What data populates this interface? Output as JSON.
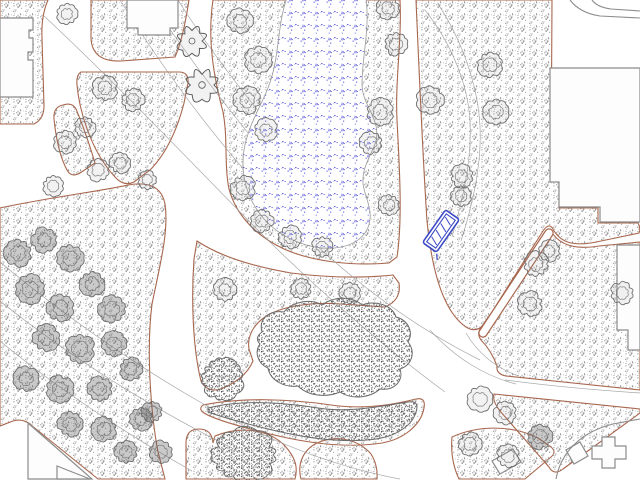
{
  "meta": {
    "kind": "landscape-site-plan",
    "width": 640,
    "height": 480
  },
  "colors": {
    "background": "#ffffff",
    "bed_edge": "#a8674e",
    "tree_stroke": "#6f6f6f",
    "tree_fill_normal": "rgba(130,130,130,0.10)",
    "tree_fill_dark": "rgba(80,80,80,0.30)",
    "flower_stroke": "#5c5c5c",
    "contour": "#9a9a9a",
    "building_fill": "#fdfdfd",
    "building_stroke": "#8c8c8c",
    "pond_stroke": "#9a9a9a",
    "pond_dot_palette": [
      "#3434cf",
      "#5151d8",
      "#8080e4",
      "#3434cf"
    ],
    "stipple_palette": [
      "#8e8e8e",
      "#a6a6a6",
      "#bcbcbc",
      "#cfcfcf"
    ],
    "stipple_dark_palette": [
      "#4f4f4f",
      "#636363",
      "#7a7a7a",
      "#909090"
    ],
    "mass_stroke": "#6a6a6a",
    "bench_blue": "#3a49c5"
  },
  "map": {
    "beds": [
      {
        "name": "bed-top-left-corner",
        "d": "M0,0 H48 Q41,16 42,38 L44,106 Q44,119 34,124 H0 Z"
      },
      {
        "name": "bed-top-strip",
        "d": "M91,0 H189 C185,26 181,44 175,57 L121,61 Q92,62 91,38 Z"
      },
      {
        "name": "bed-triangle",
        "d": "M81,72 Q76,75 77,85 C79,107 89,149 115,177 Q124,187 134,182 L150,170 C167,153 178,127 184,103 L188,83 Q189,72 179,72 Z"
      },
      {
        "name": "bed-small-left",
        "d": "M63,105 Q53,107 54,119 C56,139 60,157 67,170 Q71,178 80,173 L95,163 C89,143 82,123 76,109 Q72,102 63,105 Z"
      },
      {
        "name": "bed-pond-surround",
        "d": "M213,0 C207,40 214,78 223,112 C228,138 224,164 229,189 C236,215 256,236 284,249 C313,262 353,266 389,263 L397,257 C403,218 399,160 397,120 C395,80 402,40 400,0 Z"
      },
      {
        "name": "bed-left-large",
        "d": "M0,208 C46,198 101,191 128,185 C150,181 162,188 165,204 C169,231 160,265 152,304 C146,351 151,415 158,452 L165,479 L98,479 L31,425 Q23,418 13,421 L0,426 Z"
      },
      {
        "name": "bed-center",
        "d": "M197,241 C221,257 256,267 291,273 C331,278 366,278 393,275 L399,283 C401,295 395,303 385,307 L341,304 C311,302 281,306 265,317 C253,325 247,337 249,349 L253,361 C247,375 235,383 221,389 Q207,393 201,381 C193,349 191,301 194,259 Z"
      },
      {
        "name": "bed-snake",
        "d": "M203,405 C241,397 291,399 331,405 C366,410 396,404 416,399 Q426,397 424,408 C421,425 404,439 382,443 C344,449 300,442 262,432 C234,425 212,418 204,413 Q198,409 203,405 Z"
      },
      {
        "name": "bed-bottom-center",
        "d": "M186,479 L186,443 Q186,429 199,429 Q212,429 213,443 L215,436 C242,425 270,430 285,446 C296,458 298,468 295,479 Z"
      },
      {
        "name": "bed-bottom-mid",
        "d": "M301,479 C297,464 303,450 317,443 C337,434 359,440 371,454 Q378,465 377,479 Z"
      },
      {
        "name": "bed-bottom-right-low",
        "d": "M452,437 C478,425 512,425 538,438 L551,447 Q557,452 551,457 L525,479 L459,479 Q450,460 452,437 Z"
      },
      {
        "name": "bed-bottom-right-diagonal",
        "d": "M494,394 L640,409 L640,413 L563,469 Q554,476 549,467 L500,411 Q492,401 494,394 Z"
      },
      {
        "name": "bed-right-mid",
        "d": "M551,231 C559,245 575,250 599,246 L640,242 L640,390 L506,376 Q496,374 497,366 C493,355 487,346 481,340 Q476,333 482,326 Z"
      },
      {
        "name": "bed-right-main",
        "d": "M416,0 H552 L551,180 L559,182 L559,208 L598,208 L598,223 L638,223 Q641,228 639,233 L601,241 C576,247 561,244 553,229 Q549,222 543,231 L485,323 Q477,334 466,327 C444,312 432,272 427,221 C423,161 419,70 416,0 Z"
      }
    ],
    "narrow_paths": [
      {
        "name": "path-dead-end-diagonal",
        "d": "M549,233 L483,333",
        "width": 7
      }
    ],
    "pond": {
      "d": "M287,-2 C277,24 280,58 268,88 C260,108 248,126 244,150 C240,176 248,202 266,221 C284,240 312,250 334,248 C358,246 372,232 370,212 C368,196 360,188 364,171 C369,152 380,144 376,126 C372,110 362,100 362,84 C362,56 370,30 366,-2 Z"
    },
    "contours": [
      {
        "d": "M44,16 C100,68 170,140 240,212 C310,284 380,344 445,392"
      },
      {
        "d": "M120,0 C170,80 230,160 300,230 C360,288 420,330 480,360"
      },
      {
        "d": "M150,0 C200,75 255,145 315,210"
      },
      {
        "d": "M178,0 C222,70 280,140 340,205"
      },
      {
        "d": "M425,10 C450,42 468,82 470,122 C472,162 462,202 452,237"
      },
      {
        "d": "M438,4 C462,40 478,86 480,126 C482,166 472,206 461,241"
      },
      {
        "d": "M0,262 C60,312 130,362 200,402 C262,438 330,466 400,479"
      },
      {
        "d": "M0,301 C70,357 150,407 230,447"
      },
      {
        "d": "M0,341 C58,389 128,435 192,471"
      },
      {
        "d": "M430,330 C455,358 485,376 516,384"
      },
      {
        "d": "M466,333 C477,352 495,368 519,376"
      },
      {
        "d": "M505,380 C550,386 595,390 640,393"
      }
    ],
    "shrub_masses": [
      {
        "name": "shrub-mass-large",
        "type": "blob",
        "d": "M262,332 C258,318 270,310 284,312 C292,302 310,298 322,305 C334,296 352,296 362,305 C376,300 392,305 396,317 C408,320 414,332 408,342 C416,352 412,365 400,369 C404,381 394,391 380,389 C370,398 352,400 340,392 C326,398 308,396 298,386 C284,388 270,380 268,368 C258,364 254,352 260,344 Q254,338 262,332 Z"
      },
      {
        "name": "shrub-mass-snake",
        "type": "blob",
        "d": "M208,408 C240,400 280,402 318,408 C350,413 382,406 408,402 Q420,400 416,412 C412,426 396,436 376,439 C340,444 300,437 264,428 C236,421 216,415 208,412 Z"
      },
      {
        "name": "shrub-round-bush-1",
        "type": "round",
        "x": 244,
        "y": 455,
        "r": 33,
        "sy": 0.8
      },
      {
        "name": "shrub-round-bush-2",
        "type": "round",
        "x": 222,
        "y": 379,
        "r": 21,
        "sy": 1
      }
    ],
    "buildings": [
      {
        "name": "building-top-left",
        "d": "M0,18 H33 V30 H29 V38 H33 V52 H28 V60 H33 V97 H0 Z"
      },
      {
        "name": "building-top-small",
        "d": "M127,0 H178 V28 H170 V35 H138 V28 H127 Z"
      },
      {
        "name": "building-right-large",
        "d": "M550,68 H640 V222 H600 V207 H559 V182 H550 Z"
      },
      {
        "name": "building-right-mid",
        "d": "M617,245 H640 V350 H628 V330 H617 Z"
      },
      {
        "name": "building-bottom-right-cross",
        "d": "M592,446 h10 v-9 h13 v9 h11 v13 h-11 v9 h-13 v-9 h-10 Z"
      },
      {
        "name": "building-bottom-right-small",
        "d": "M566,450 l14,-8 8,14 -14,8 Z"
      },
      {
        "name": "building-bottom-center-small",
        "d": "M492,461 L513,449 L521,462 L500,474 Z"
      },
      {
        "name": "building-ramp-triangle-1",
        "d": "M28,423 L92,479 L28,479 Z"
      },
      {
        "name": "building-ramp-triangle-2",
        "d": "M57,466 L90,479 L57,479 Z"
      }
    ],
    "building_lines": [
      {
        "name": "building-arc-bottom-right",
        "d": "M556,479 C561,452 581,432 613,424 L640,419"
      },
      {
        "name": "building-curve-top-right-1",
        "d": "M570,0 Q580,13 600,16 L640,18"
      },
      {
        "name": "building-curve-top-right-2",
        "d": "M592,0 Q597,7 611,9 L640,11"
      }
    ],
    "trees": [
      {
        "x": 67,
        "y": 14,
        "r": 10,
        "style": "normal"
      },
      {
        "x": 105,
        "y": 88,
        "r": 12,
        "style": "normal"
      },
      {
        "x": 133,
        "y": 100,
        "r": 11,
        "style": "normal"
      },
      {
        "x": 85,
        "y": 127,
        "r": 10,
        "style": "normal"
      },
      {
        "x": 65,
        "y": 142,
        "r": 11,
        "style": "normal"
      },
      {
        "x": 98,
        "y": 170,
        "r": 11,
        "style": "normal"
      },
      {
        "x": 53,
        "y": 186,
        "r": 10,
        "style": "normal"
      },
      {
        "x": 120,
        "y": 163,
        "r": 10,
        "style": "normal"
      },
      {
        "x": 147,
        "y": 180,
        "r": 9,
        "style": "normal"
      },
      {
        "x": 192,
        "y": 41,
        "r": 12,
        "style": "flower"
      },
      {
        "x": 202,
        "y": 85,
        "r": 13,
        "style": "flower"
      },
      {
        "x": 240,
        "y": 21,
        "r": 12,
        "style": "normal"
      },
      {
        "x": 258,
        "y": 60,
        "r": 13,
        "style": "normal"
      },
      {
        "x": 247,
        "y": 100,
        "r": 13,
        "style": "normal"
      },
      {
        "x": 266,
        "y": 130,
        "r": 11,
        "style": "normal"
      },
      {
        "x": 243,
        "y": 188,
        "r": 12,
        "style": "normal"
      },
      {
        "x": 262,
        "y": 221,
        "r": 11,
        "style": "normal"
      },
      {
        "x": 290,
        "y": 237,
        "r": 11,
        "style": "normal"
      },
      {
        "x": 322,
        "y": 247,
        "r": 10,
        "style": "normal"
      },
      {
        "x": 388,
        "y": 8,
        "r": 11,
        "style": "normal"
      },
      {
        "x": 396,
        "y": 44,
        "r": 11,
        "style": "normal"
      },
      {
        "x": 380,
        "y": 112,
        "r": 13,
        "style": "normal"
      },
      {
        "x": 371,
        "y": 143,
        "r": 11,
        "style": "normal"
      },
      {
        "x": 389,
        "y": 205,
        "r": 10,
        "style": "normal"
      },
      {
        "x": 430,
        "y": 100,
        "r": 13,
        "style": "normal"
      },
      {
        "x": 490,
        "y": 65,
        "r": 12,
        "style": "normal"
      },
      {
        "x": 496,
        "y": 112,
        "r": 12,
        "style": "normal"
      },
      {
        "x": 462,
        "y": 176,
        "r": 11,
        "style": "normal"
      },
      {
        "x": 461,
        "y": 196,
        "r": 10,
        "style": "normal"
      },
      {
        "x": 536,
        "y": 264,
        "r": 12,
        "style": "normal"
      },
      {
        "x": 549,
        "y": 251,
        "r": 10,
        "style": "normal"
      },
      {
        "x": 530,
        "y": 304,
        "r": 12,
        "style": "normal"
      },
      {
        "x": 622,
        "y": 293,
        "r": 11,
        "style": "normal"
      },
      {
        "x": 480,
        "y": 399,
        "r": 12,
        "style": "normal"
      },
      {
        "x": 505,
        "y": 413,
        "r": 11,
        "style": "normal"
      },
      {
        "x": 540,
        "y": 437,
        "r": 12,
        "style": "dark"
      },
      {
        "x": 470,
        "y": 444,
        "r": 11,
        "style": "normal"
      },
      {
        "x": 508,
        "y": 456,
        "r": 11,
        "style": "normal"
      },
      {
        "x": 225,
        "y": 290,
        "r": 11,
        "style": "normal"
      },
      {
        "x": 301,
        "y": 289,
        "r": 10,
        "style": "normal"
      },
      {
        "x": 350,
        "y": 293,
        "r": 10,
        "style": "normal"
      },
      {
        "x": 18,
        "y": 253,
        "r": 13,
        "style": "dark"
      },
      {
        "x": 44,
        "y": 240,
        "r": 12,
        "style": "dark"
      },
      {
        "x": 70,
        "y": 258,
        "r": 13,
        "style": "dark"
      },
      {
        "x": 30,
        "y": 289,
        "r": 14,
        "style": "dark"
      },
      {
        "x": 60,
        "y": 308,
        "r": 13,
        "style": "dark"
      },
      {
        "x": 92,
        "y": 284,
        "r": 12,
        "style": "dark"
      },
      {
        "x": 112,
        "y": 309,
        "r": 13,
        "style": "dark"
      },
      {
        "x": 46,
        "y": 338,
        "r": 13,
        "style": "dark"
      },
      {
        "x": 80,
        "y": 349,
        "r": 14,
        "style": "dark"
      },
      {
        "x": 114,
        "y": 344,
        "r": 12,
        "style": "dark"
      },
      {
        "x": 26,
        "y": 379,
        "r": 12,
        "style": "dark"
      },
      {
        "x": 60,
        "y": 389,
        "r": 13,
        "style": "dark"
      },
      {
        "x": 100,
        "y": 389,
        "r": 12,
        "style": "dark"
      },
      {
        "x": 131,
        "y": 369,
        "r": 11,
        "style": "dark"
      },
      {
        "x": 141,
        "y": 419,
        "r": 11,
        "style": "dark"
      },
      {
        "x": 104,
        "y": 429,
        "r": 12,
        "style": "dark"
      },
      {
        "x": 70,
        "y": 424,
        "r": 12,
        "style": "dark"
      },
      {
        "x": 152,
        "y": 412,
        "r": 10,
        "style": "dark"
      },
      {
        "x": 161,
        "y": 452,
        "r": 11,
        "style": "dark"
      },
      {
        "x": 126,
        "y": 452,
        "r": 11,
        "style": "dark"
      }
    ],
    "bench": {
      "x": 441,
      "y": 231,
      "w": 40,
      "h": 17,
      "angle": -55
    }
  }
}
